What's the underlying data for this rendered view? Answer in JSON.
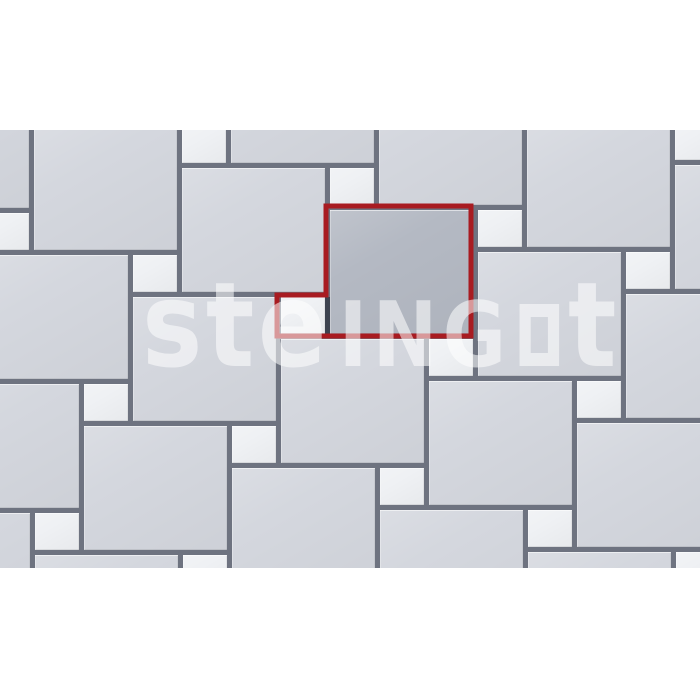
{
  "image": {
    "width": 700,
    "height": 700,
    "background": "#ffffff"
  },
  "pattern_area": {
    "left": 0,
    "top": 130,
    "width": 700,
    "height": 438
  },
  "colors": {
    "background": "#ffffff",
    "joint": "#6e7380",
    "large_tile": "#d4d7de",
    "small_tile": "#eff1f4",
    "highlight_tile": "#b4b9c3",
    "module_outline_red": "#a81b21",
    "module_inner_joint": "#3d4350",
    "watermark": "rgba(255,255,255,0.55)"
  },
  "pattern": {
    "type": "hopscotch-paving",
    "description": "repeating module: large square paver with small square paver at its bottom-left corner",
    "anchor": [
      330,
      210
    ],
    "t1": [
      148,
      42
    ],
    "t2": [
      -49,
      129
    ],
    "large_size": [
      143,
      124
    ],
    "small_size": [
      44,
      37
    ],
    "small_offset": [
      -49,
      87
    ],
    "a_range": [
      -3,
      3
    ],
    "b_range": [
      -2,
      3
    ],
    "highlight_module": [
      0,
      0
    ]
  },
  "module_outline": {
    "points": "326,76 471,76 471,206 277,206 277,165 326,165",
    "stroke_width": 5
  },
  "inner_joint": {
    "x": 325,
    "y": 167,
    "width": 5,
    "height": 37
  },
  "watermark": {
    "part1": "ste",
    "part2": "ING",
    "square_glyph": "outlined-square-o",
    "part3": "t"
  }
}
